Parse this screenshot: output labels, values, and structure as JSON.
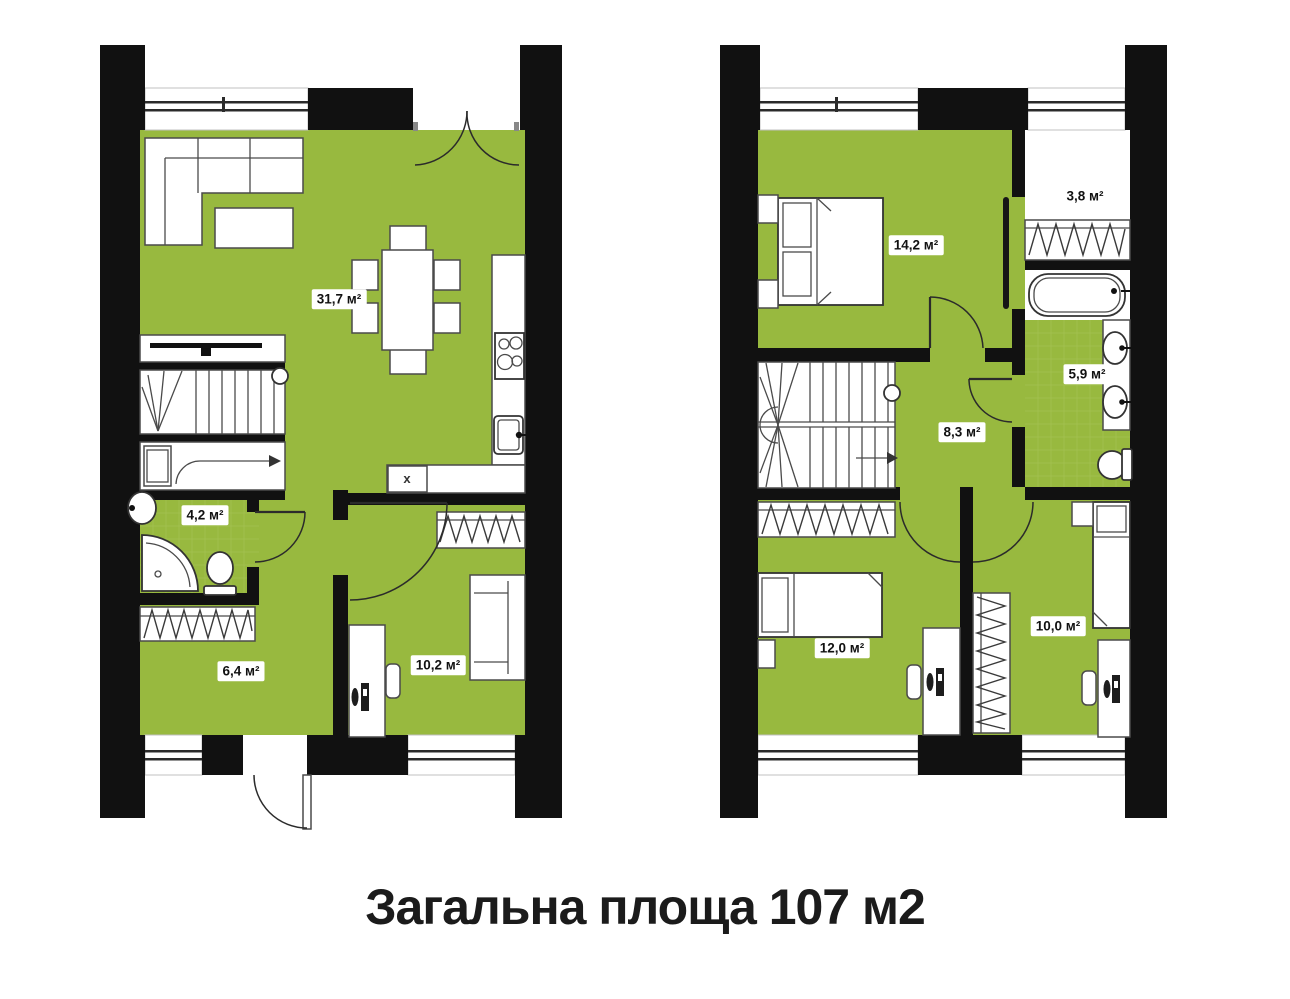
{
  "title": "Загальна площа 107 м2",
  "floor1": {
    "rooms": {
      "living": "31,7 м²",
      "bathroom": "4,2 м²",
      "hallway": "6,4 м²",
      "bedroom": "10,2 м²"
    },
    "appliance_marker": "x"
  },
  "floor2": {
    "rooms": {
      "bedroom_master": "14,2 м²",
      "closet": "3,8 м²",
      "bathroom": "5,9 м²",
      "hall": "8,3 м²",
      "bedroom_left": "12,0 м²",
      "bedroom_right": "10,0 м²"
    }
  },
  "colors": {
    "floor_fill": "#98b93f",
    "wall": "#111111",
    "title_text": "#1b1b1b"
  }
}
